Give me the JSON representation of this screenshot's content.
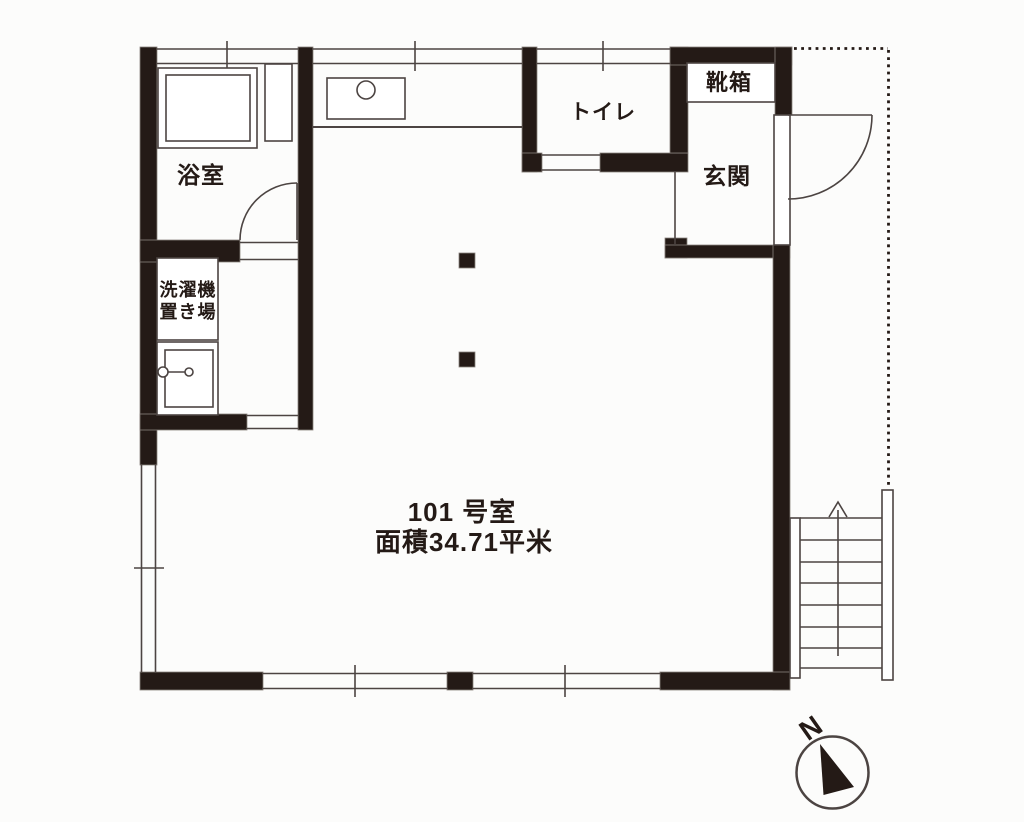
{
  "plan": {
    "unit": {
      "line1": "101 号室",
      "line2": "面積34.71平米"
    },
    "rooms": {
      "bathroom": "浴室",
      "laundry_line1": "洗濯機",
      "laundry_line2": "置き場",
      "toilet": "トイレ",
      "shoe_cabinet": "靴箱",
      "entrance": "玄関"
    },
    "compass": {
      "north": "N"
    },
    "colors": {
      "wall": "#241a16",
      "line": "#4c4442",
      "background": "#fcfcfb"
    }
  }
}
